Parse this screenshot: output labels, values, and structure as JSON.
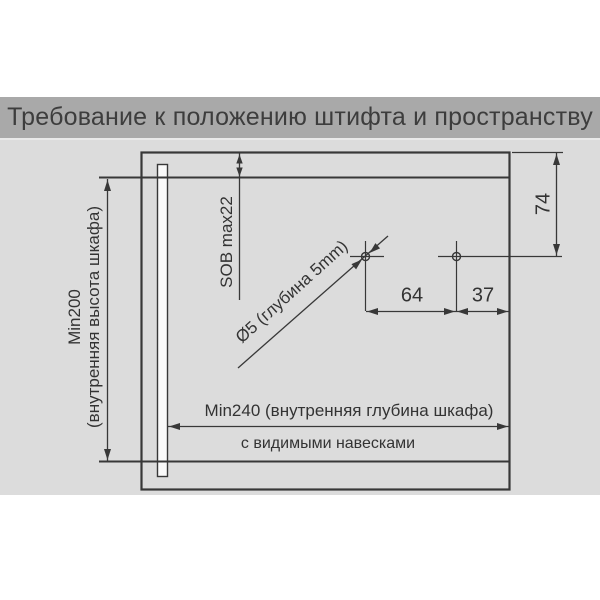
{
  "title": "Требование к положению штифта и пространству",
  "colors": {
    "banner_bg": "#a9a9a9",
    "banner_text": "#3d3d3d",
    "drawing_bg": "#dcdcdc",
    "line": "#383838",
    "label_text": "#333333"
  },
  "drawing": {
    "labels": {
      "inner_height_value": "Min200",
      "inner_height_desc": "(внутренняя высота шкафа)",
      "top_clearance": "SOB max22",
      "pin_to_top": "74",
      "pin_spacing": "64",
      "pin_to_edge": "37",
      "hole_spec": "Ø5 (глубина 5mm)",
      "inner_depth": "Min240 (внутренняя глубина шкафа)",
      "hinges_note": "с видимыми навесками"
    }
  }
}
